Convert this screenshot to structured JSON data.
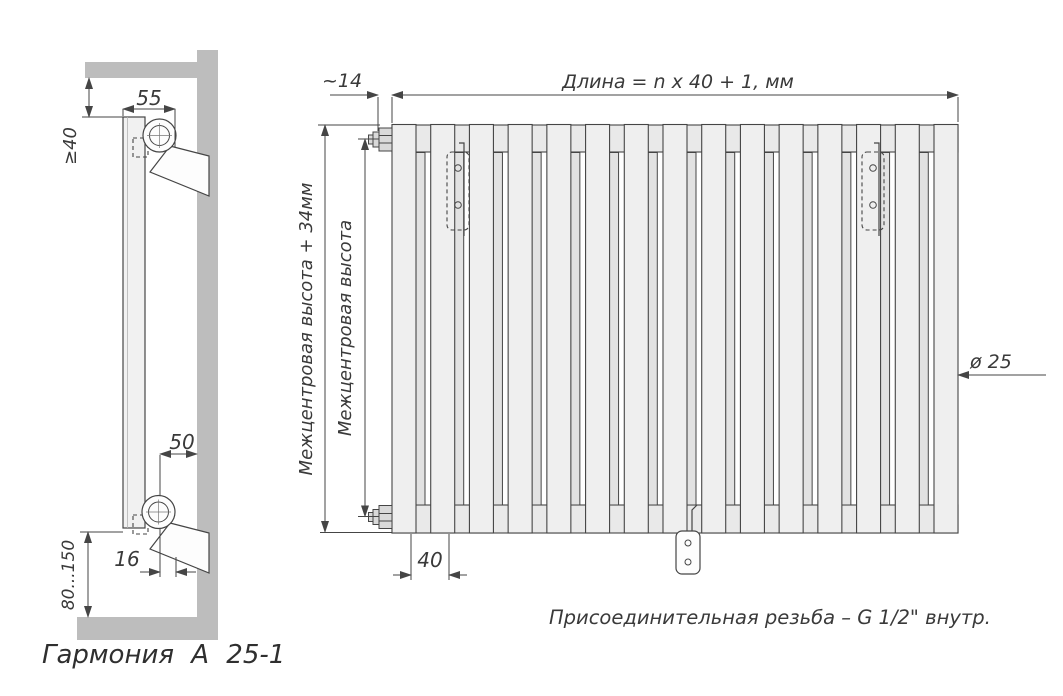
{
  "drawing_title": "Гармония А 25-1",
  "side_view": {
    "label": "Гармония А 25-1",
    "dim_top_offset": "55",
    "dim_ceiling_gap": "≥40",
    "dim_wall_distance": "50",
    "dim_pipe_offset": "16",
    "dim_floor_gap": "80...150"
  },
  "front_view": {
    "dim_end_offset": "~14",
    "dim_length_formula": "Длина = n x 40 + 1, мм",
    "dim_height_outer": "Межцентровая высота + 34мм",
    "dim_height_inner": "Межцентровая высота",
    "dim_tube_diameter": "ø 25",
    "dim_tube_pitch": "40",
    "caption": "Присоединительная резьба – G 1/2\" внутр.",
    "tube_count_front": 15,
    "tube_count_back": 14
  },
  "colors": {
    "background": "#ffffff",
    "wall": "#bdbdbd",
    "line": "#454545",
    "tube_fill": "#efefef",
    "tube_back_fill": "#e2e2e2",
    "header_fill": "#e9e9e9",
    "text": "#3a3a3a"
  }
}
